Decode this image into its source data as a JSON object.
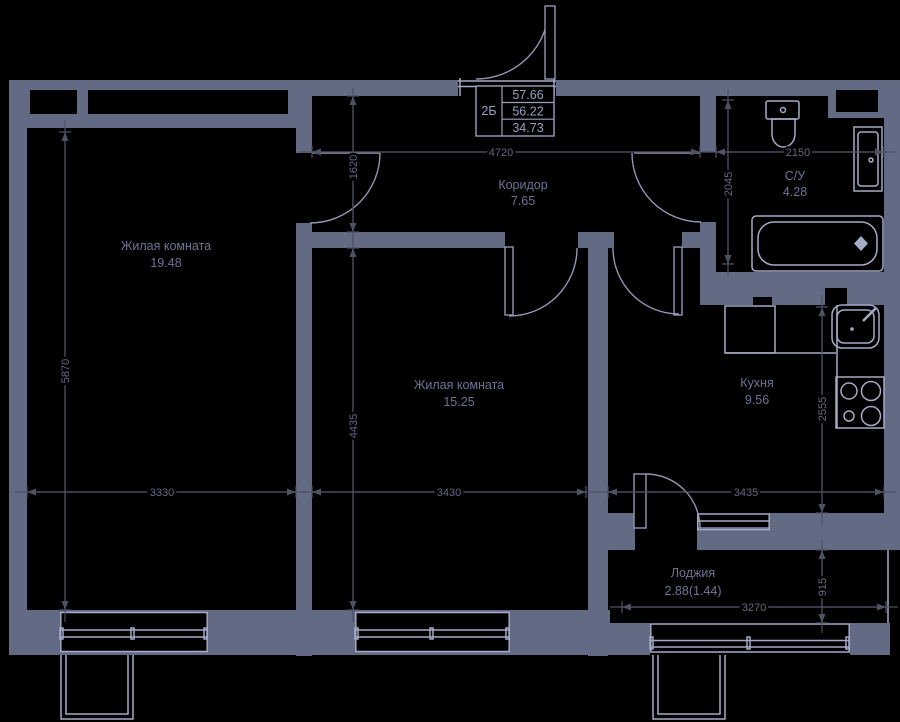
{
  "plan": {
    "info_table": {
      "unit": "2Б",
      "total_with_balcony": "57.66",
      "total": "56.22",
      "living": "34.73"
    },
    "rooms": {
      "living1": {
        "name": "Жилая комната",
        "area": "19.48"
      },
      "living2": {
        "name": "Жилая комната",
        "area": "15.25"
      },
      "corridor": {
        "name": "Коридор",
        "area": "7.65"
      },
      "bathroom": {
        "name": "С/У",
        "area": "4.28"
      },
      "kitchen": {
        "name": "Кухня",
        "area": "9.56"
      },
      "loggia": {
        "name": "Лоджия",
        "area": "2.88(1.44)"
      }
    },
    "dimensions": {
      "corridor_width": "4720",
      "bathroom_width": "2150",
      "room1_height": "5870",
      "corridor_height": "1620",
      "bathroom_height": "2045",
      "room2_height": "4435",
      "kitchen_height": "2555",
      "loggia_depth": "915",
      "room1_width": "3330",
      "room2_width": "3430",
      "kitchen_width": "3435",
      "loggia_width": "3270"
    },
    "colors": {
      "background": "#000000",
      "wall": "#636b84",
      "fixture_line": "#a6abc6",
      "door_line": "#9298b4",
      "dim_line": "#4c5164",
      "dim_text": "#636a82",
      "room_text": "#6d7494",
      "table_text": "#99a0bd"
    }
  }
}
